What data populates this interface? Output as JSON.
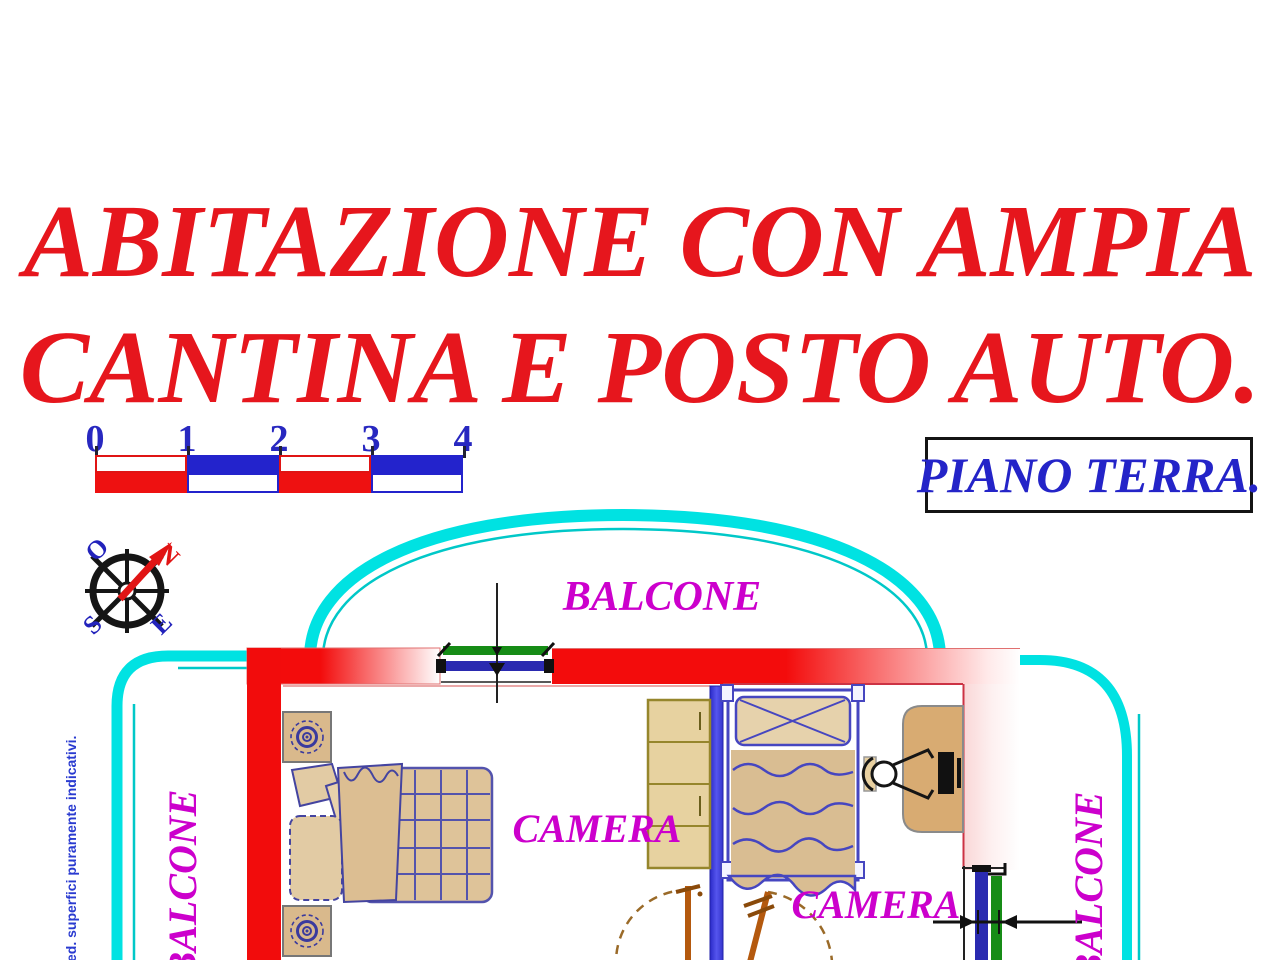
{
  "title": {
    "line1": "ABITAZIONE CON AMPIA",
    "line2": "CANTINA E POSTO AUTO."
  },
  "floor_label": "PIANO TERRA.",
  "scale_bar": {
    "ticks": [
      "0",
      "1",
      "2",
      "3",
      "4"
    ]
  },
  "compass": {
    "north": "N",
    "west": "O",
    "south": "S",
    "east": "E"
  },
  "plan": {
    "balcony_top": "BALCONE",
    "balcony_left": "BALCONE",
    "balcony_right": "BALCONE",
    "camera_left": "CAMERA",
    "camera_right": "CAMERA"
  },
  "disclaimer": "ed. superfici puramente indicativi.",
  "colors": {
    "title_red": "#e6161d",
    "wall_red": "#f20c0c",
    "balcony_cyan": "#00e2e2",
    "partition_blue": "#4040dd",
    "label_magenta": "#cc00cc",
    "blue_text": "#2424c8",
    "window_green": "#168c16",
    "window_blue": "#2a2ab0",
    "furniture_tan": "#d9b98c",
    "door_brown": "#b4590e"
  }
}
